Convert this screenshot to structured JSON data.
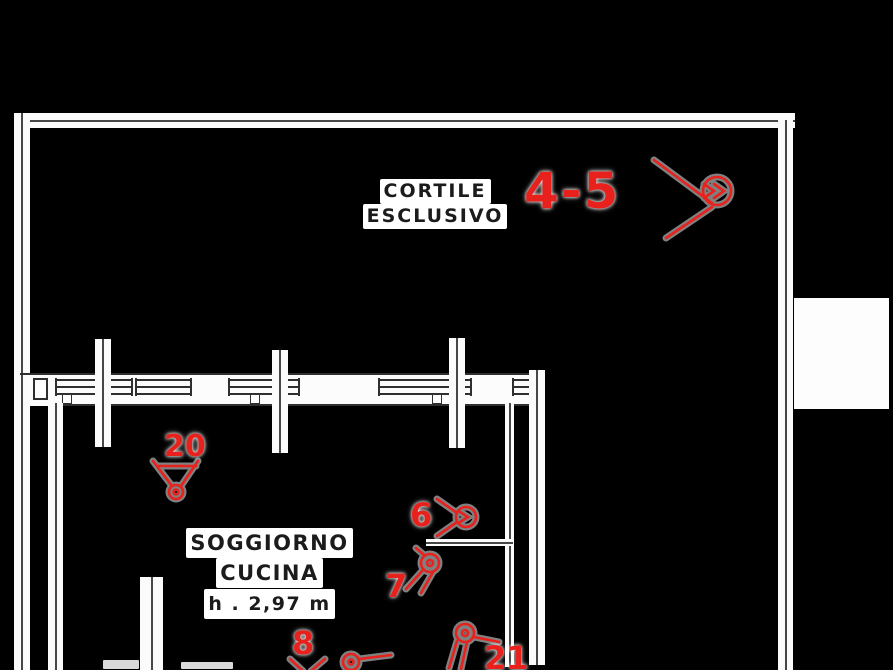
{
  "floorplan": {
    "rooms": [
      {
        "name_lines": [
          "CORTILE",
          "ESCLUSIVO"
        ]
      },
      {
        "name_lines": [
          "SOGGIORNO",
          "CUCINA"
        ],
        "height_note": "h . 2,97 m"
      }
    ],
    "photo_markers": [
      {
        "label": "4-5"
      },
      {
        "label": "20"
      },
      {
        "label": "6"
      },
      {
        "label": "7"
      },
      {
        "label": "8"
      },
      {
        "label": "21"
      }
    ],
    "colors": {
      "marker_red": "#e8211d",
      "wall_line": "#474747",
      "wall_fill": "#ffffff",
      "background": "#000000"
    }
  }
}
